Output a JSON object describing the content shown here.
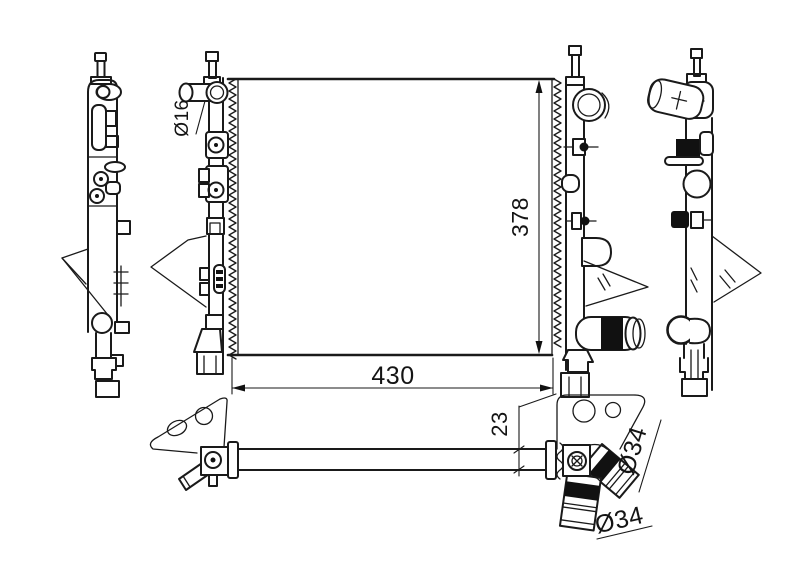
{
  "figure": {
    "colors": {
      "background": "#ffffff",
      "line": "#1a1a1a",
      "solid_fill": "#111111"
    },
    "labels": {
      "inlet_diameter": "Ø16",
      "core_height": "378",
      "core_width": "430",
      "pipe_offset": "23",
      "outlet_upper": "Ø34",
      "outlet_lower": "Ø34"
    }
  }
}
